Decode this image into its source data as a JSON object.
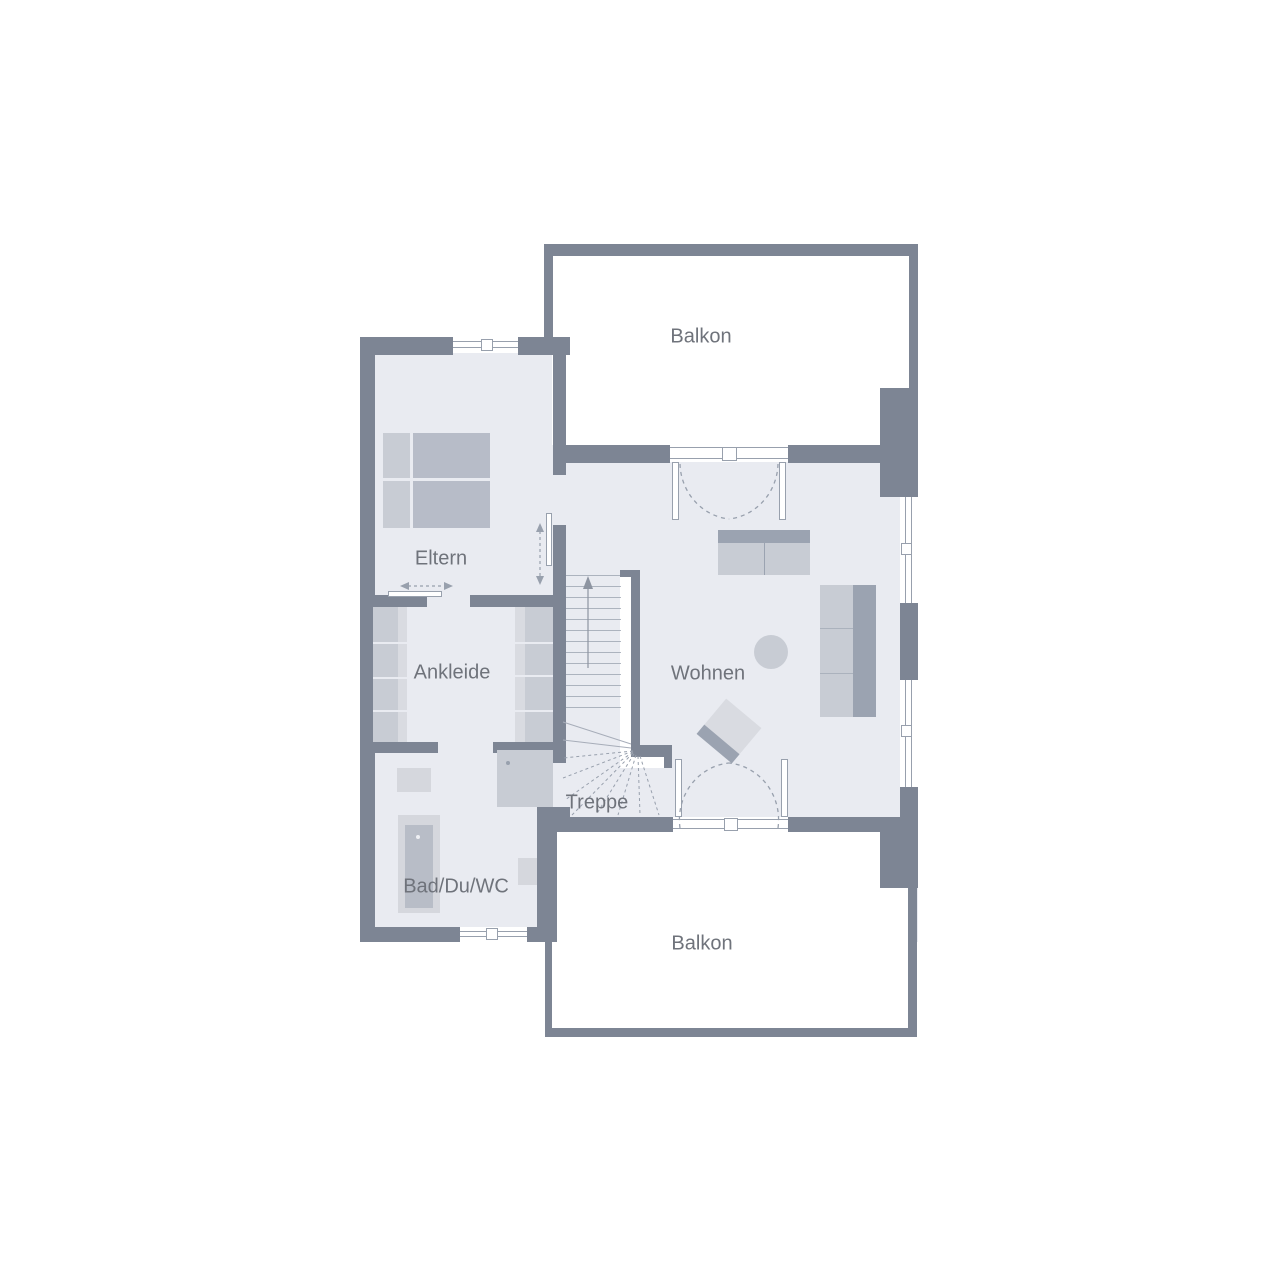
{
  "labels": {
    "balkon_top": "Balkon",
    "eltern": "Eltern",
    "ankleide": "Ankleide",
    "wohnen": "Wohnen",
    "treppe": "Treppe",
    "bad": "Bad/Du/WC",
    "balkon_bottom": "Balkon"
  },
  "colors": {
    "wall": "#7d8594",
    "floor": "#e9ebf1",
    "outside": "#ffffff",
    "furniture": "#c8ccd4",
    "furniture_dark": "#9ba3b1",
    "furniture_mid": "#b7bcc8",
    "furniture_light": "#d9dbe1",
    "fixture": "#d5d7dd",
    "fixture_dark": "#b8bdc7",
    "line": "#98a0ad",
    "label": "#6f737b"
  }
}
